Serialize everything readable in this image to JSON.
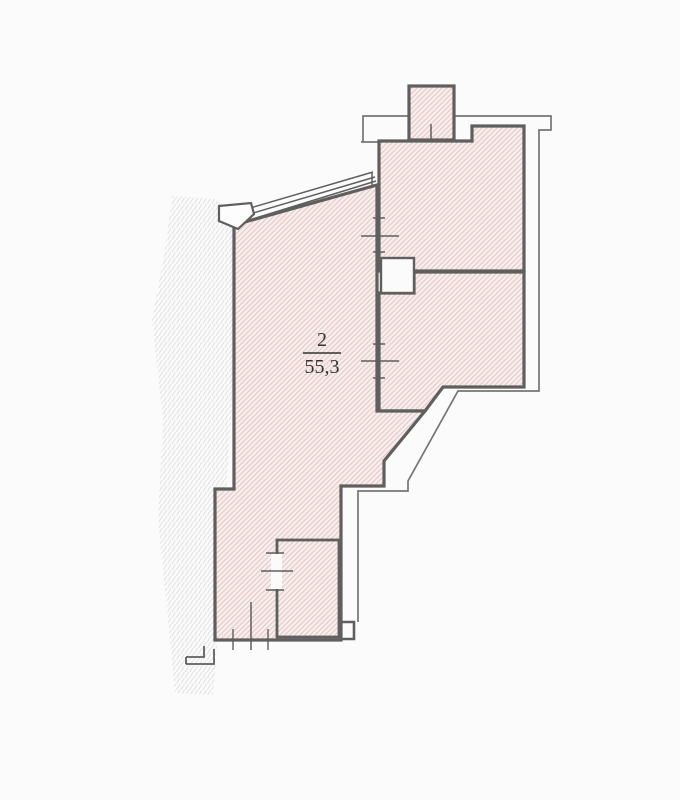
{
  "unit": {
    "number": "2",
    "area": "55,3"
  },
  "colors": {
    "background": "#fcfbfb",
    "wall": "#5f5f5f",
    "outline": "#757575",
    "room_fill": "#f9efee",
    "hatch_line": "#e5cdca",
    "terrain_hatch": "#d9d9de",
    "label_text": "#333333"
  }
}
